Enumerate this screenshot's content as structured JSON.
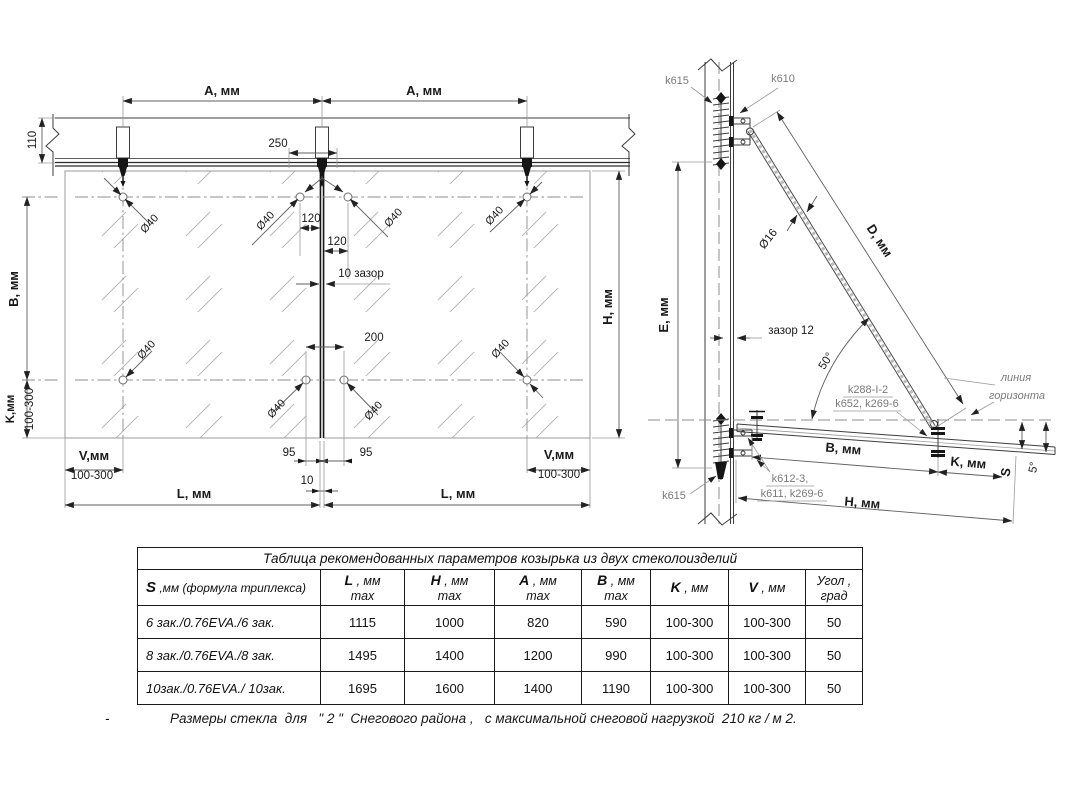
{
  "front_view": {
    "a_label": "A, мм",
    "d110": "110",
    "d250": "250",
    "d120": "120",
    "gap_label": "10 зазор",
    "d200": "200",
    "hole": "Ø40",
    "b_label": "B, мм",
    "h_label": "H, мм",
    "k_label": "K,мм",
    "range": "100-300",
    "v_label": "V,мм",
    "l_label": "L,  мм",
    "d95": "95",
    "d10": "10"
  },
  "side_view": {
    "k615": "k615",
    "k610": "k610",
    "d16": "Ø16",
    "d_label": "D, мм",
    "e_label": "E, мм",
    "gap12": "зазор 12",
    "a50": "50°",
    "k288": "k288-I-2",
    "k652": "k652, k269-6",
    "horizon1": "линия",
    "horizon2": "горизонта",
    "b_label": "B, мм",
    "k_label": "K, мм",
    "s_label": "S",
    "a5": "5°",
    "k612": "k612-3,",
    "k611": "k611, k269-6",
    "h_label": "H, мм"
  },
  "table": {
    "title": "Таблица рекомендованных параметров  козырька из двух стеколоизделий",
    "col_s_sym": "S",
    "col_s_rest": " ,мм (формула триплекса)",
    "columns": [
      {
        "sym": "L",
        "unit": " , мм",
        "sub": "max"
      },
      {
        "sym": "H",
        "unit": " , мм",
        "sub": "max"
      },
      {
        "sym": "A",
        "unit": " , мм",
        "sub": "max"
      },
      {
        "sym": "B",
        "unit": " , мм",
        "sub": "max"
      },
      {
        "sym": "K",
        "unit": " , мм",
        "sub": ""
      },
      {
        "sym": "V",
        "unit": " , мм",
        "sub": ""
      },
      {
        "sym": "",
        "unit": "Угол ,",
        "sub": "град"
      }
    ],
    "rows": [
      {
        "formula": "6 зак./0.76EVA./6 зак.",
        "values": [
          "1115",
          "1000",
          "820",
          "590",
          "100-300",
          "100-300",
          "50"
        ]
      },
      {
        "formula": "8 зак./0.76EVA./8 зак.",
        "values": [
          "1495",
          "1400",
          "1200",
          "990",
          "100-300",
          "100-300",
          "50"
        ]
      },
      {
        "formula": "10зак./0.76EVA./ 10зак.",
        "values": [
          "1695",
          "1600",
          "1400",
          "1190",
          "100-300",
          "100-300",
          "50"
        ]
      }
    ]
  },
  "footnote": {
    "dash": "-",
    "text": "Размеры стекла  для   \" 2 \"  Снегового района ,   с максимальной снеговой нагрузкой  210 кг / м 2."
  }
}
